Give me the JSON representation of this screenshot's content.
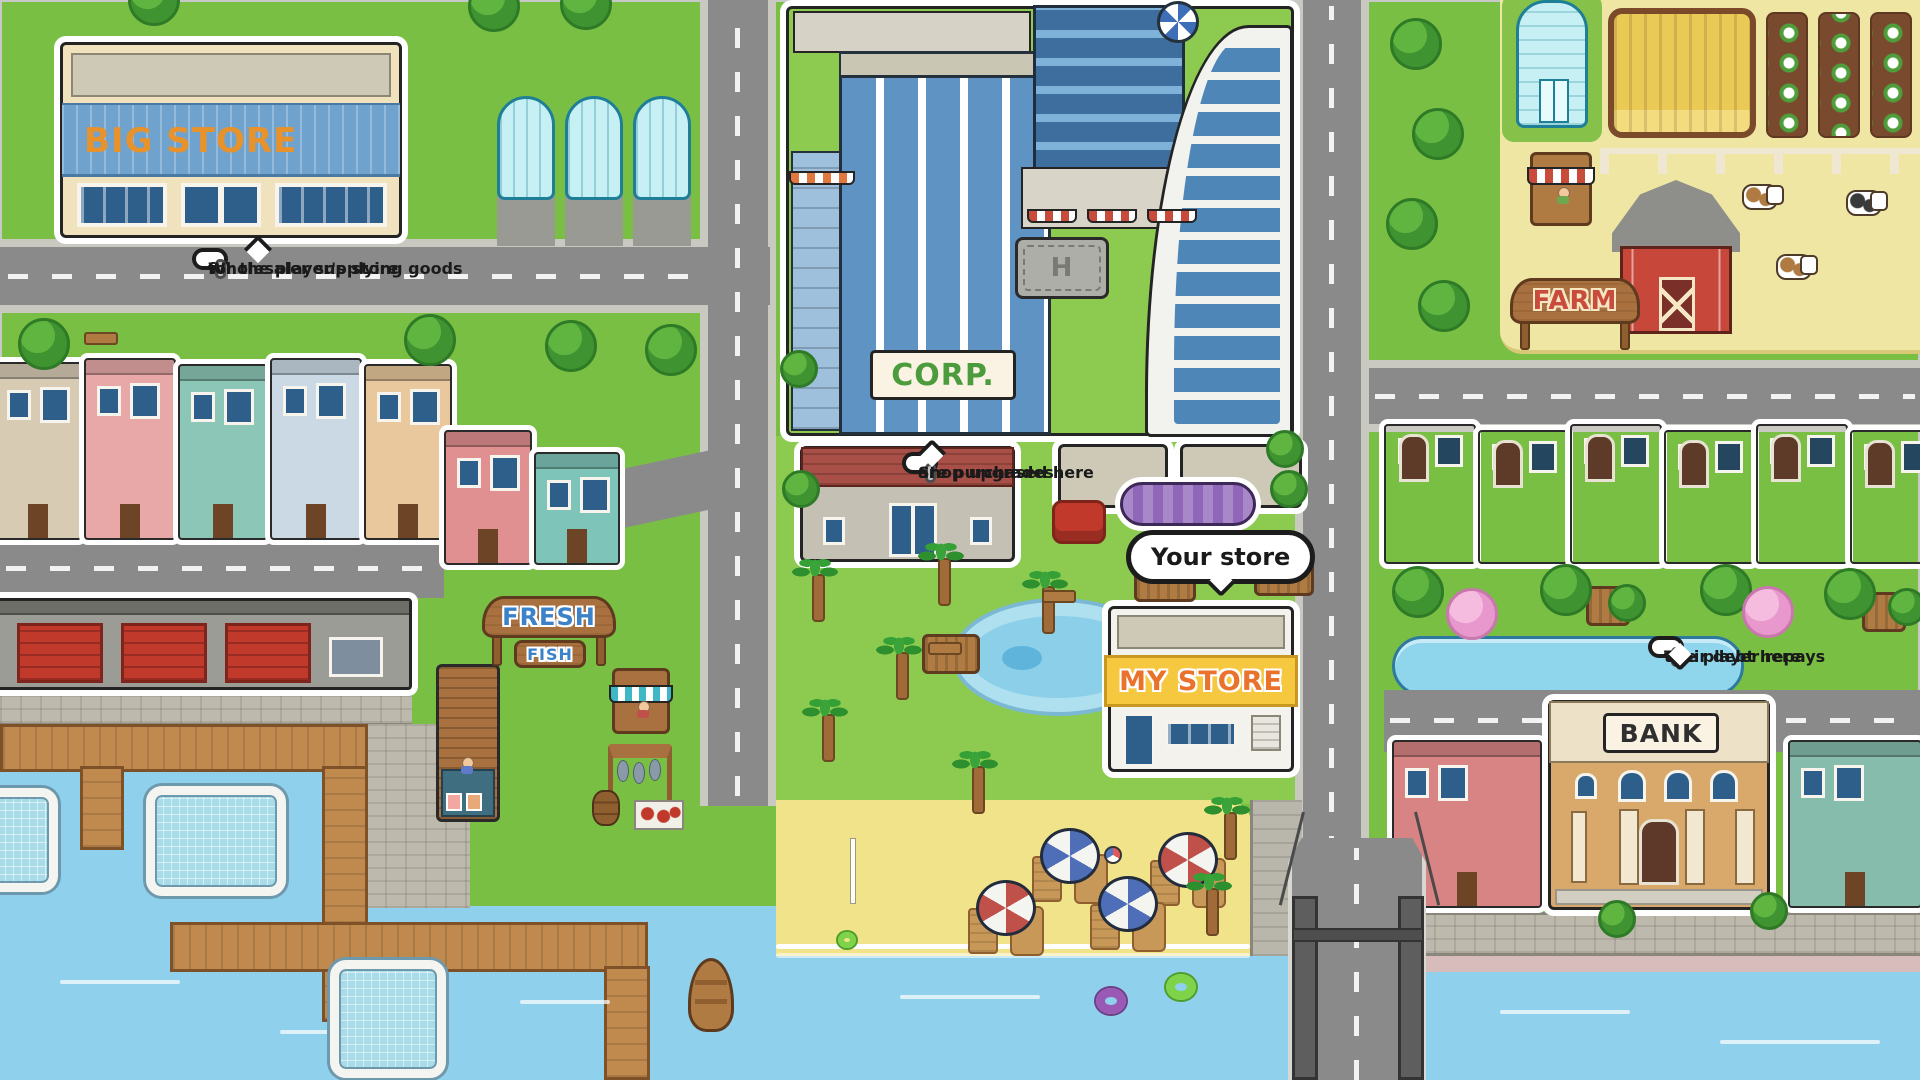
{
  "map": {
    "signs": {
      "big_store": "BIG STORE",
      "corp": "CORP.",
      "my_store": "MY STORE",
      "fresh": "FRESH",
      "fish": "FISH",
      "farm": "FARM",
      "bank": "BANK",
      "helipad_letter": "H"
    },
    "tooltips": {
      "wholesaler": {
        "line1": "Wholesaler supplying goods",
        "line2": "for the player's store"
      },
      "upgrades": {
        "line1": "Shop upgrades",
        "line2": "are purchased here"
      },
      "bank_debt": {
        "line1": "The player repays",
        "line2": "their debt here"
      }
    },
    "labels": {
      "your_store": "Your store"
    },
    "colors": {
      "grass": "#79BF44",
      "park_grass": "#8CCB50",
      "road": "#8A8A8A",
      "sidewalk": "#C9C8C1",
      "water": "#8FD0EC",
      "sand": "#F1E38A",
      "ink": "#1C1C1C",
      "big_store_text": "#E8922C",
      "big_store_panel": "#6FA3CE",
      "corp_text": "#4C9B3D",
      "my_store_text": "#E9732C",
      "my_store_panel": "#F6C840",
      "fresh_fish_text": "#3B82C8",
      "farm_text": "#C84B3B",
      "bank_sign_text": "#2F2F2F",
      "umbrella_blue": "#4E6EB8",
      "umbrella_red": "#C0504A",
      "canopy_purple": "#9066B8",
      "left_houses": [
        "#D8CBB4",
        "#E8A8A8",
        "#8CC6B6",
        "#CBD9E5",
        "#E8C89C",
        "#E09090",
        "#7FC4B8"
      ],
      "right_houses": [
        {
          "up": "#A8C8DC",
          "lo": "#6E8CA8"
        },
        {
          "up": "#EBD9A8",
          "lo": "#C8A878"
        },
        {
          "up": "#E08C8C",
          "lo": "#B86060"
        },
        {
          "up": "#BFE5D2",
          "lo": "#7A7695"
        },
        {
          "up": "#EBCE96",
          "lo": "#A8734E"
        },
        {
          "up": "#8CC8C0",
          "lo": "#5E9890"
        }
      ]
    }
  }
}
